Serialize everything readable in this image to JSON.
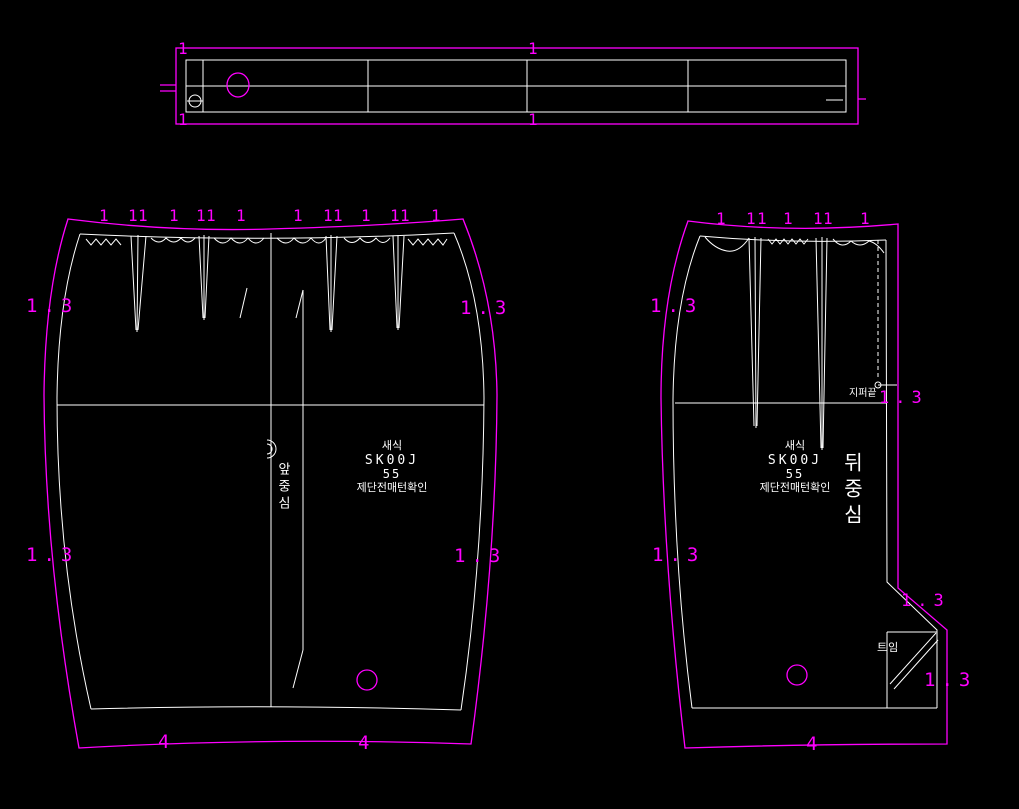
{
  "app": {
    "description": "apparel pattern CAD drafting canvas"
  },
  "colors": {
    "background": "#000000",
    "cut_line": "#ff00ff",
    "draft_line": "#ffffff"
  },
  "labels": {
    "notch": "1",
    "seam_allowance": "1.3",
    "hem_allowance": "4",
    "zipper_end": "지퍼끝",
    "vent": "트임",
    "center_front": "앞중심",
    "center_back": "뒤중심"
  },
  "pattern_info": {
    "style_label": "새식",
    "style_no": "SK00J",
    "size": "55",
    "note": "제단전매턴확인"
  }
}
